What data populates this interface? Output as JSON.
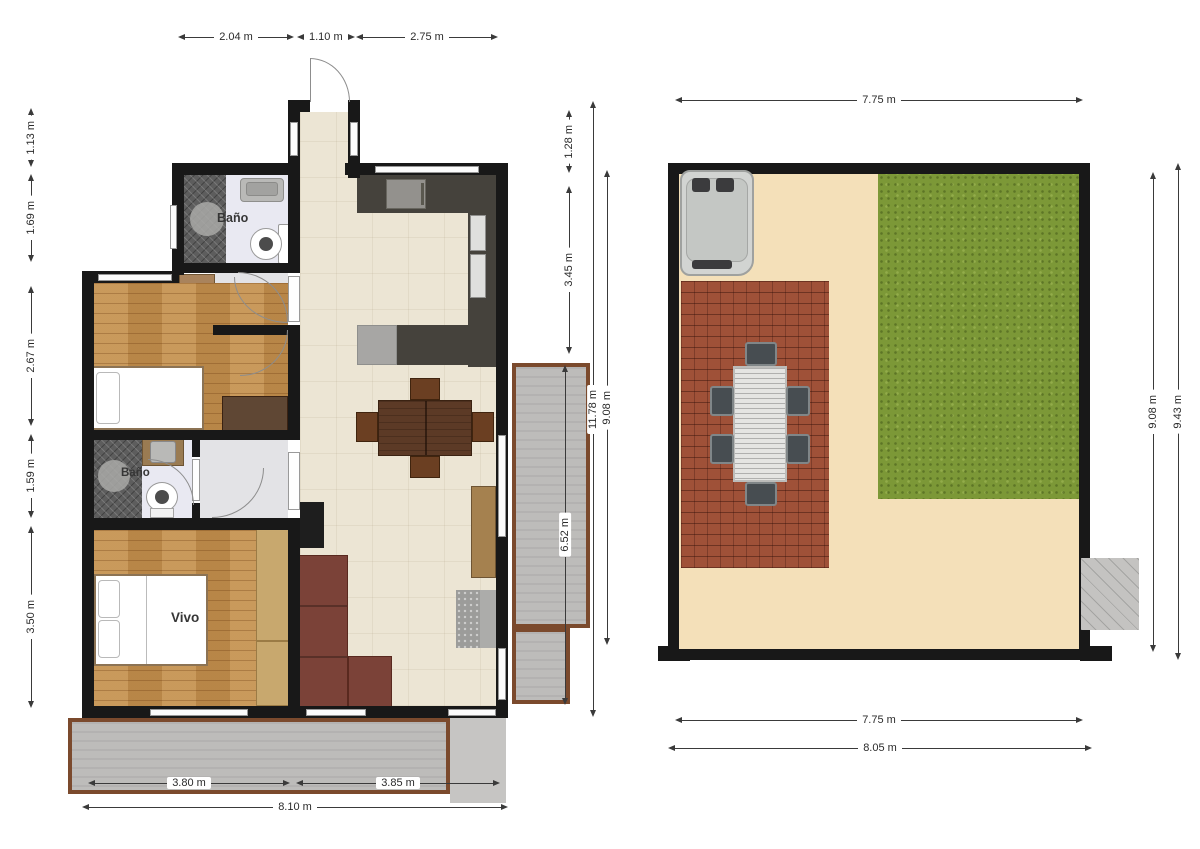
{
  "house_plan": {
    "name": "Apartment floor plan",
    "rooms": {
      "bath_top_label": "Baño",
      "bath_mid_label": "Baño",
      "bedroom_label": "Vivo"
    },
    "dims_top": [
      "2.04 m",
      "1.10 m",
      "2.75 m"
    ],
    "dims_left": [
      "1.13 m",
      "1.69 m",
      "2.67 m",
      "1.59 m",
      "3.50 m"
    ],
    "dims_right": [
      "1.28 m",
      "3.45 m",
      "6.52 m",
      "11.78 m",
      "9.08 m"
    ],
    "dims_bottom": [
      "3.80 m",
      "3.85 m",
      "8.10 m"
    ]
  },
  "yard_plan": {
    "name": "Yard plan",
    "dims_top": [
      "7.75 m"
    ],
    "dims_right": [
      "9.08 m",
      "9.43 m"
    ],
    "dims_bottom": [
      "7.75 m",
      "8.05 m"
    ]
  },
  "colors": {
    "wall": "#181818",
    "tile_floor": "#ece5d4",
    "wood_floor": "#c3904f",
    "bath_floor": "#e9e9f2",
    "shower_tile": "#5d5d5d",
    "kitchen_counter": "#45423c",
    "deck_gray": "#bdbcba",
    "deck_border_brown": "#7b4a2d",
    "sand": "#f4e0b9",
    "grass": "#7c9837",
    "brick_patio": "#9f5138",
    "sofa": "#7b4238"
  }
}
